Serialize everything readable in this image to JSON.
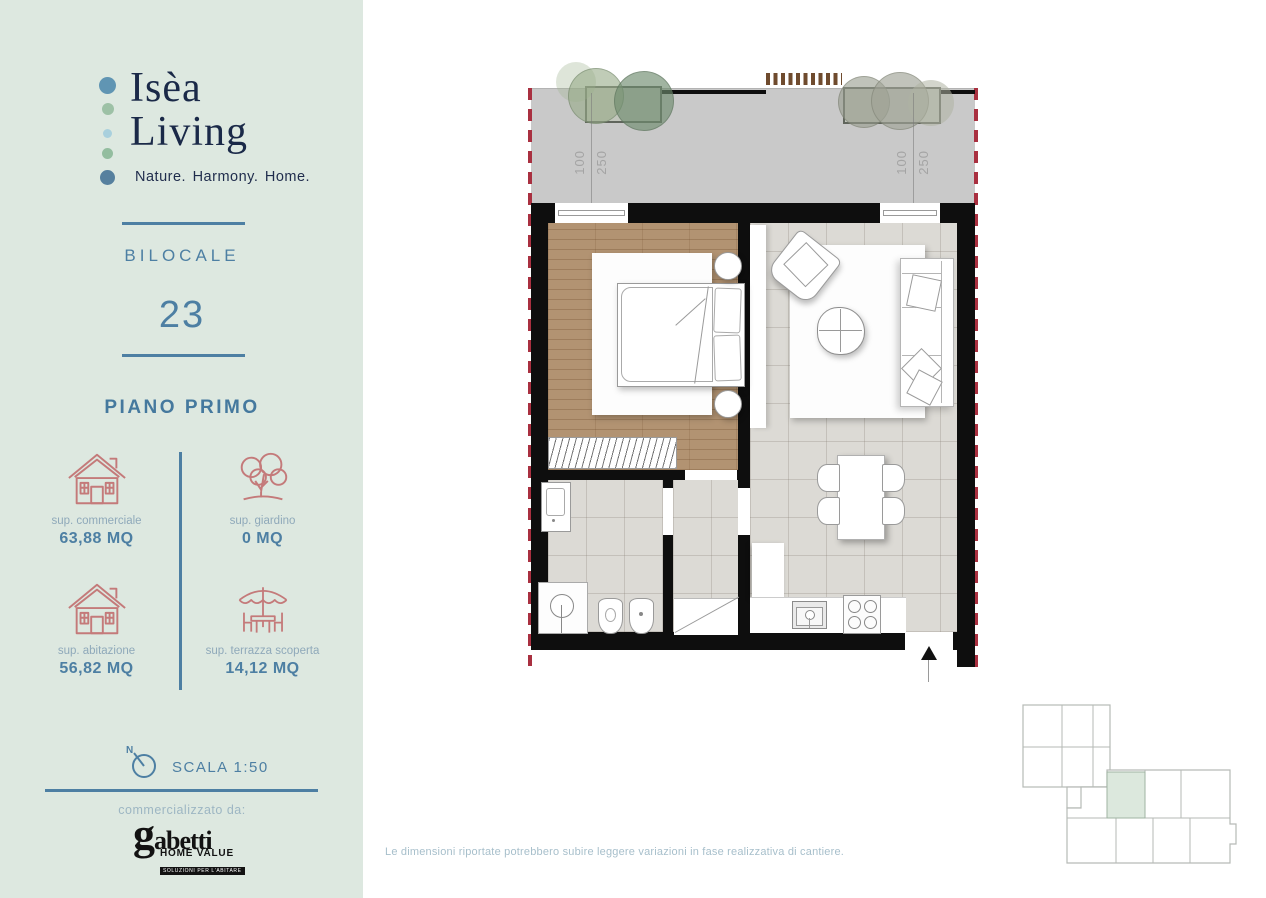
{
  "sidebar": {
    "brand": {
      "name_line1": "Isèa",
      "name_line2": "Living",
      "tagline": "Nature. Harmony. Home.",
      "dot_colors": [
        "#6095b3",
        "#9dc1a6",
        "#a9d0dd",
        "#93bd9f",
        "#56809e"
      ]
    },
    "unit_type": "BILOCALE",
    "unit_number": "23",
    "floor": "PIANO PRIMO",
    "stats": [
      {
        "icon": "house-icon",
        "label": "sup. commerciale",
        "value": "63,88 MQ"
      },
      {
        "icon": "tree-icon",
        "label": "sup. giardino",
        "value": "0 MQ"
      },
      {
        "icon": "house-icon",
        "label": "sup. abitazione",
        "value": "56,82 MQ"
      },
      {
        "icon": "terrace-icon",
        "label": "sup. terrazza scoperta",
        "value": "14,12 MQ"
      }
    ],
    "scale": {
      "north_label": "N",
      "text": "SCALA 1:50"
    },
    "marketed_by_label": "commercializzato da:",
    "broker_logo": {
      "name": "gabetti",
      "line1": "HOME VALUE",
      "line2": "SOLUZIONI PER L'ABITARE"
    }
  },
  "plan": {
    "dimension_labels": [
      {
        "width": "100",
        "height": "250"
      },
      {
        "width": "100",
        "height": "250"
      }
    ]
  },
  "footer": {
    "disclaimer": "Le dimensioni riportate potrebbero subire leggere variazioni in fase realizzativa di cantiere."
  },
  "colors": {
    "sidebar_bg": "#dde8e0",
    "accent_blue": "#4d7fa3",
    "label_gray_blue": "#8fa9ba",
    "icon_rose": "#c47a7a",
    "brand_navy": "#1a2948",
    "terrace_gray": "#c9c9c9",
    "wood_floor": "#b29372",
    "tile_floor": "#dcdad5",
    "wall_black": "#0e0e0e",
    "boundary_red": "#a93040",
    "keyplan_highlight": "#dce8dd"
  }
}
